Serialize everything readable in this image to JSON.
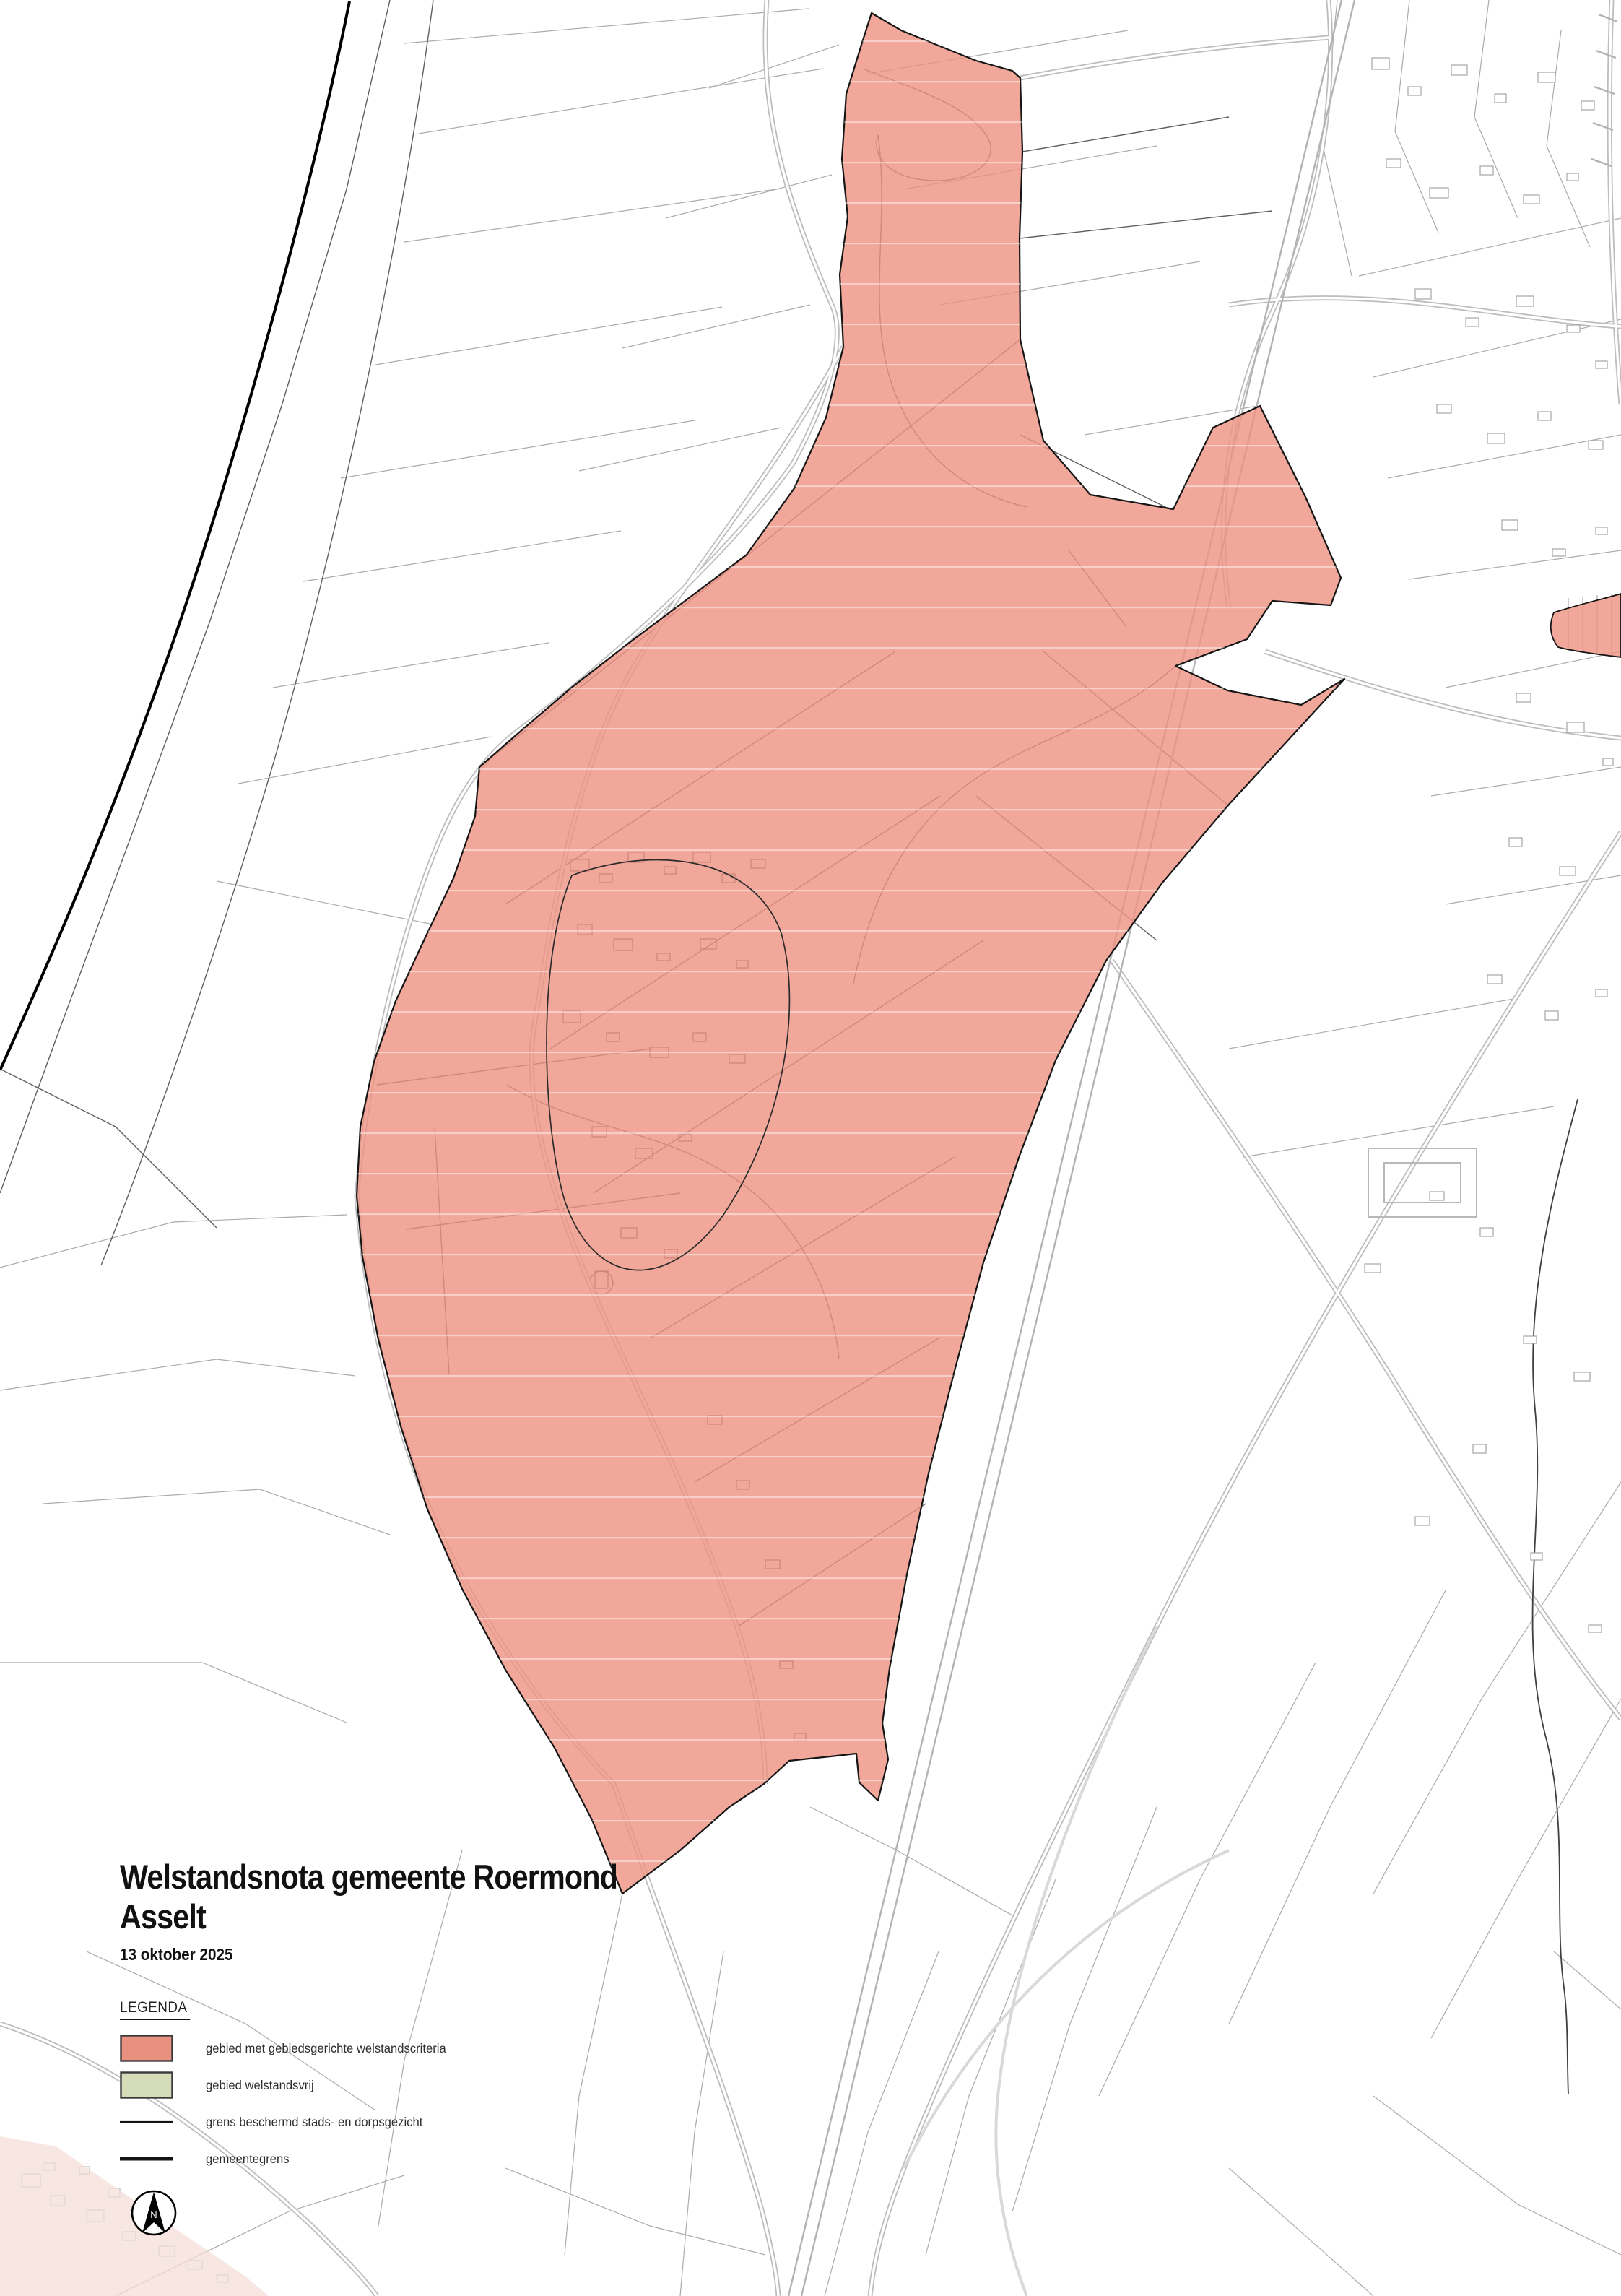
{
  "title_block": {
    "title": "Welstandsnota gemeente Roermond",
    "subtitle": "Asselt",
    "date": "13 oktober 2025"
  },
  "legend": {
    "heading": "LEGENDA",
    "items": [
      {
        "label": "gebied met gebiedsgerichte welstandscriteria",
        "type": "area-fill",
        "fill": "#E89181",
        "border": "#3A3A3A"
      },
      {
        "label": "gebied welstandsvrij",
        "type": "area-fill",
        "fill": "#D5DCB8",
        "border": "#3A3A3A"
      },
      {
        "label": "grens beschermd stads- en dorpsgezicht",
        "type": "line-thin",
        "color": "#141414"
      },
      {
        "label": "gemeentegrens",
        "type": "line-thick",
        "color": "#141414"
      }
    ]
  },
  "north_arrow": {
    "label": "N"
  },
  "colors": {
    "background": "#FFFFFF",
    "criteria_area_fill": "#ED9180",
    "criteria_area_border": "#151515",
    "welstandsvrij_fill": "#D5DCB8",
    "adjacent_settlement_fill": "#F4DED8",
    "parcel_line_faint": "#ABABAB",
    "parcel_line_dark": "#5F5F5F",
    "road_casing": "#BDBDBD",
    "railway_line": "#B3B3B3",
    "municipal_boundary": "#000000",
    "stream_line": "#3F3F3F"
  }
}
